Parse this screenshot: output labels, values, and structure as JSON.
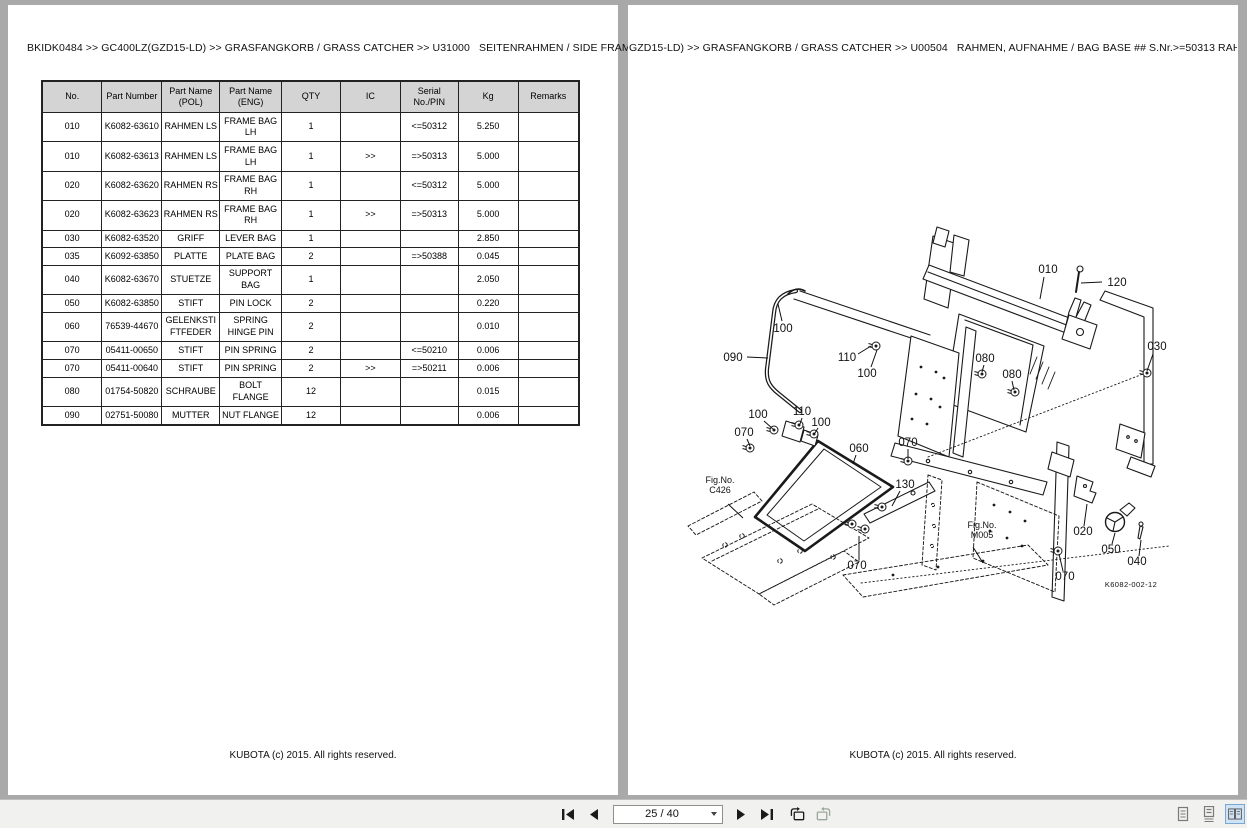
{
  "colors": {
    "canvas_bg": "#a9a9a9",
    "page_bg": "#ffffff",
    "toolbar_bg": "#f1f1f0",
    "table_header_bg": "#d4d4d4",
    "selected_view_bg": "#cfe3f5",
    "line_color": "#1a1a1a"
  },
  "left_page": {
    "breadcrumb": "BKIDK0484 >> GC400LZ(GZD15-LD) >> GRASFANGKORB / GRASS CATCHER >> U31000   SEITENRAHMEN / SIDE FRAME",
    "footer": "KUBOTA (c) 2015. All rights reserved.",
    "table": {
      "headers": [
        "No.",
        "Part Number",
        "Part Name (POL)",
        "Part Name (ENG)",
        "QTY",
        "IC",
        "Serial No./PIN",
        "Kg",
        "Remarks"
      ],
      "rows": [
        [
          "010",
          "K6082-63610",
          "RAHMEN LS",
          "FRAME BAG LH",
          "1",
          "",
          "<=50312",
          "5.250",
          ""
        ],
        [
          "010",
          "K6082-63613",
          "RAHMEN LS",
          "FRAME BAG LH",
          "1",
          ">>",
          "=>50313",
          "5.000",
          ""
        ],
        [
          "020",
          "K6082-63620",
          "RAHMEN RS",
          "FRAME BAG RH",
          "1",
          "",
          "<=50312",
          "5.000",
          ""
        ],
        [
          "020",
          "K6082-63623",
          "RAHMEN RS",
          "FRAME BAG RH",
          "1",
          ">>",
          "=>50313",
          "5.000",
          ""
        ],
        [
          "030",
          "K6082-63520",
          "GRIFF",
          "LEVER BAG",
          "1",
          "",
          "",
          "2.850",
          ""
        ],
        [
          "035",
          "K6092-63850",
          "PLATTE",
          "PLATE BAG",
          "2",
          "",
          "=>50388",
          "0.045",
          ""
        ],
        [
          "040",
          "K6082-63670",
          "STUETZE",
          "SUPPORT BAG",
          "1",
          "",
          "",
          "2.050",
          ""
        ],
        [
          "050",
          "K6082-63850",
          "STIFT",
          "PIN LOCK",
          "2",
          "",
          "",
          "0.220",
          ""
        ],
        [
          "060",
          "76539-44670",
          "GELENKSTIFTFEDER",
          "SPRING HINGE PIN",
          "2",
          "",
          "",
          "0.010",
          ""
        ],
        [
          "070",
          "05411-00650",
          "STIFT",
          "PIN SPRING",
          "2",
          "",
          "<=50210",
          "0.006",
          ""
        ],
        [
          "070",
          "05411-00640",
          "STIFT",
          "PIN SPRING",
          "2",
          ">>",
          "=>50211",
          "0.006",
          ""
        ],
        [
          "080",
          "01754-50820",
          "SCHRAUBE",
          "BOLT FLANGE",
          "12",
          "",
          "",
          "0.015",
          ""
        ],
        [
          "090",
          "02751-50080",
          "MUTTER",
          "NUT FLANGE",
          "12",
          "",
          "",
          "0.006",
          ""
        ]
      ]
    }
  },
  "right_page": {
    "breadcrumb": "GZD15-LD) >> GRASFANGKORB / GRASS CATCHER >> U00504   RAHMEN, AUFNAHME / BAG BASE ## S.Nr.>=50313 RAHMEN,",
    "footer": "KUBOTA (c) 2015. All rights reserved.",
    "diagram": {
      "drawing_number": "K6082-002-12",
      "drawing_number_pos": [
        503,
        582
      ],
      "labels": [
        {
          "t": "010",
          "x": 420,
          "y": 268,
          "l": [
            416,
            272,
            412,
            294
          ]
        },
        {
          "t": "120",
          "x": 489,
          "y": 281,
          "l": [
            474,
            277,
            453,
            278
          ]
        },
        {
          "t": "100",
          "x": 155,
          "y": 327,
          "l": [
            154,
            316,
            150,
            299
          ]
        },
        {
          "t": "090",
          "x": 105,
          "y": 356,
          "l": [
            119,
            352,
            140,
            353
          ]
        },
        {
          "t": "110",
          "x": 219,
          "y": 356,
          "l": [
            230,
            349,
            243,
            341
          ]
        },
        {
          "t": "100",
          "x": 239,
          "y": 372,
          "l": [
            243,
            362,
            249,
            345
          ]
        },
        {
          "t": "030",
          "x": 529,
          "y": 345,
          "l": [
            525,
            349,
            519,
            366
          ]
        },
        {
          "t": "080",
          "x": 357,
          "y": 357,
          "l": [
            356,
            360,
            354,
            367
          ]
        },
        {
          "t": "080",
          "x": 384,
          "y": 373,
          "l": [
            384,
            376,
            386,
            385
          ]
        },
        {
          "t": "100",
          "x": 130,
          "y": 413,
          "l": [
            136,
            416,
            145,
            424
          ]
        },
        {
          "t": "110",
          "x": 174,
          "y": 410,
          "l": [
            174,
            413,
            172,
            419
          ]
        },
        {
          "t": "100",
          "x": 193,
          "y": 421,
          "l": [
            190,
            423,
            187,
            428
          ]
        },
        {
          "t": "070",
          "x": 116,
          "y": 431,
          "l": [
            119,
            434,
            122,
            441
          ]
        },
        {
          "t": "060",
          "x": 231,
          "y": 447,
          "l": [
            228,
            450,
            225,
            459
          ]
        },
        {
          "t": "070",
          "x": 280,
          "y": 441,
          "l": [
            280,
            444,
            280,
            454
          ]
        },
        {
          "t": "130",
          "x": 277,
          "y": 483,
          "l": [
            272,
            486,
            264,
            501
          ]
        },
        {
          "t": "070",
          "x": 229,
          "y": 564,
          "l": [
            231,
            555,
            231,
            531
          ]
        },
        {
          "t": "020",
          "x": 455,
          "y": 530,
          "l": [
            456,
            521,
            459,
            499
          ]
        },
        {
          "t": "050",
          "x": 483,
          "y": 548,
          "l": [
            484,
            539,
            487,
            528
          ]
        },
        {
          "t": "040",
          "x": 509,
          "y": 560,
          "l": [
            511,
            551,
            513,
            535
          ]
        },
        {
          "t": "070",
          "x": 437,
          "y": 575,
          "l": [
            435,
            566,
            431,
            549
          ]
        }
      ],
      "fig_refs": [
        {
          "line1": "Fig.No.",
          "line2": "C426",
          "x": 92,
          "y": 478,
          "l": [
            100,
            499,
            115,
            513
          ]
        },
        {
          "line1": "Fig.No.",
          "line2": "M005",
          "x": 354,
          "y": 523,
          "l": [
            345,
            542,
            355,
            558
          ]
        }
      ]
    }
  },
  "toolbar": {
    "page_indicator": "25 / 40",
    "nav_icons": [
      "first-page-icon",
      "previous-page-icon",
      "next-page-icon",
      "last-page-icon",
      "previous-view-icon",
      "next-view-icon"
    ],
    "view_icons": [
      "single-page-icon",
      "continuous-pages-icon",
      "facing-pages-icon"
    ],
    "selected_view": "facing-pages"
  }
}
